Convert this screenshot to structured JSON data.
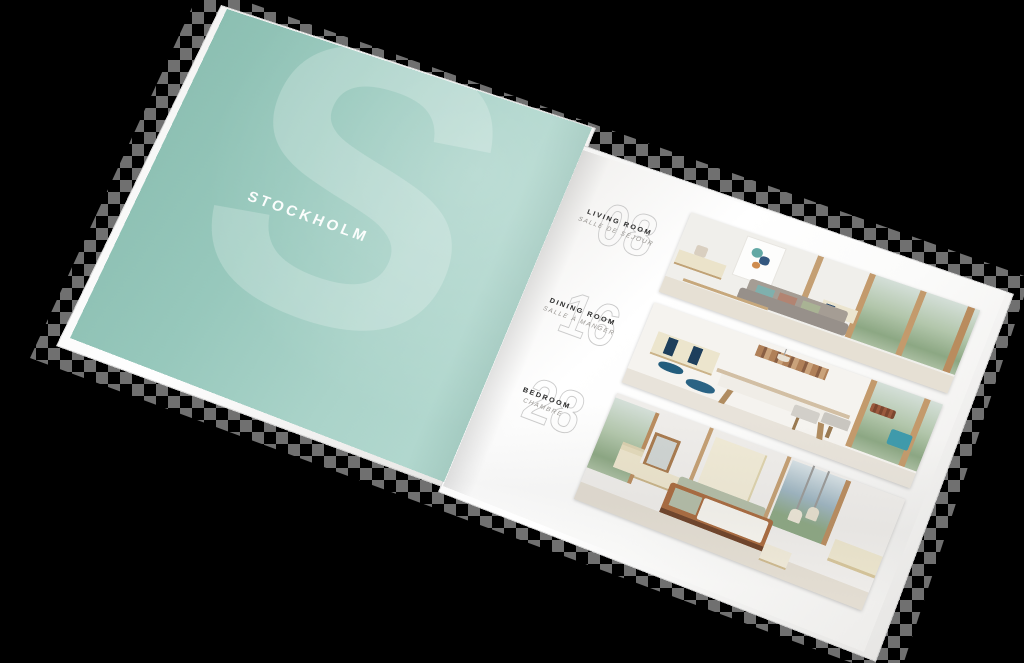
{
  "background_color": "#000000",
  "brochure": {
    "left_page": {
      "title": "STOCKHOLM",
      "watermark_letter": "S",
      "page_color": "#9ccabf"
    },
    "right_page": {
      "page_color": "#ffffff",
      "sections": [
        {
          "page_number": "08",
          "title": "LIVING ROOM",
          "subtitle": "SALLE DE SÉJOUR"
        },
        {
          "page_number": "16",
          "title": "DINING ROOM",
          "subtitle": "SALLE À MANGER"
        },
        {
          "page_number": "28",
          "title": "BEDROOM",
          "subtitle": "CHAMBRE"
        }
      ]
    },
    "palette": {
      "mint": "#9ccabf",
      "navy_accent": "#235d7d",
      "teal_accent": "#3f9aab",
      "cream_furniture": "#ece5cd",
      "caramel_wood": "#a96a3e",
      "sage": "#b3bda7"
    }
  }
}
